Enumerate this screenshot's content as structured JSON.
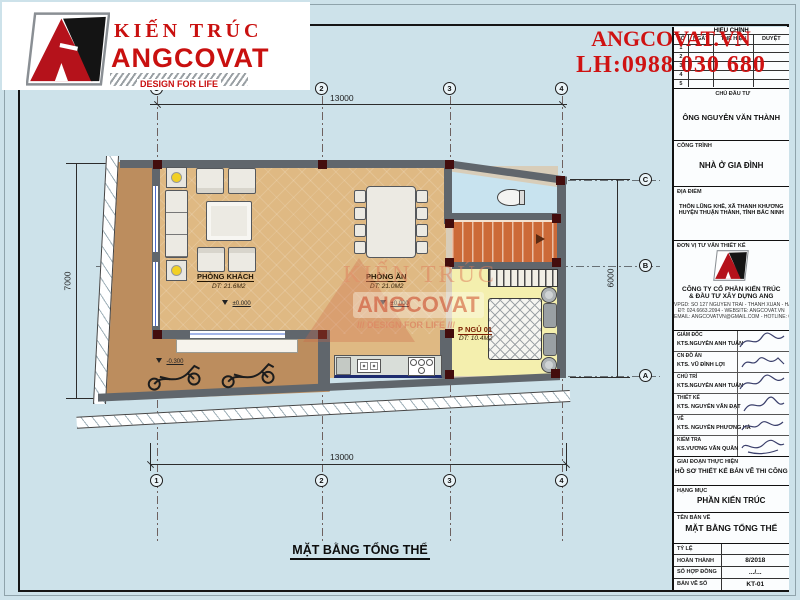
{
  "colors": {
    "background_blue": "#cde2ea",
    "accent_red": "#c9100f",
    "wall_gray": "#60666c",
    "floor_tan": "#dfb983",
    "garage_tan": "#bc8d5e",
    "bedroom_yellow": "#f4efae",
    "wc_blue": "#c8e3ef",
    "stair_orange": "#cc6a38",
    "column_maroon": "#430d0d"
  },
  "logo": {
    "brand_top": "KIẾN TRÚC",
    "brand_main": "ANGCOVAT",
    "tagline": "DESIGN FOR LIFE"
  },
  "contact_header": {
    "website": "ANGCOVAT.VN",
    "phone": "LH:0988 030 680"
  },
  "drawing": {
    "title": "MẶT BẰNG TỔNG THỂ",
    "dimensions": {
      "top": "13000",
      "bottom": "13000",
      "left": "7000",
      "right": "6000"
    },
    "grid": {
      "columns": [
        "1",
        "2",
        "3",
        "4"
      ],
      "rows": [
        "C",
        "B",
        "A"
      ]
    },
    "rooms": {
      "living": {
        "name": "PHÒNG KHÁCH",
        "area": "DT: 21.6M2",
        "level": "±0.000"
      },
      "dining": {
        "name": "PHÒNG ĂN",
        "area": "DT: 21.0M2",
        "level": "±0.000"
      },
      "bedroom": {
        "name": "P NGỦ 01",
        "area": "DT: 10.4M2"
      },
      "garage": {
        "level": "-0.300"
      }
    },
    "watermark": {
      "line1": "KIẾN TRÚC",
      "line2": "ANGCOVAT",
      "line3": "/// DESIGN FOR LIFE ///"
    }
  },
  "titleblock": {
    "revision": {
      "title": "HIỆU CHỈNH",
      "columns": [
        "SỐ",
        "NGÀY",
        "THỂ HIỆN",
        "DUYỆT"
      ],
      "rows": [
        "1",
        "2",
        "3",
        "4",
        "5"
      ]
    },
    "client": {
      "label": "CHỦ ĐẦU TƯ",
      "value": "ÔNG NGUYỄN VĂN THÀNH"
    },
    "project": {
      "label": "CÔNG TRÌNH",
      "value": "NHÀ Ở GIA ĐÌNH"
    },
    "location": {
      "label": "ĐỊA ĐIỂM",
      "line1": "THÔN LŨNG KHÊ, XÃ THANH KHƯƠNG",
      "line2": "HUYỆN THUẬN THÀNH, TỈNH BẮC NINH"
    },
    "consultant": {
      "label": "ĐƠN VỊ TƯ VẤN THIẾT KẾ",
      "company_line1": "CÔNG TY CỔ PHẦN KIẾN TRÚC",
      "company_line2": "& ĐẦU TƯ XÂY DỰNG ANG",
      "contact1": "VPGD: SỐ 127 NGUYỄN TRÃI - THANH XUÂN - HÀ NỘI",
      "contact2": "ĐT: 024.6663.2094 - WEBSITE: ANGCOVAT.VN",
      "contact3": "EMAIL: ANGCOVATVN@GMAIL.COM - HOTLINE: 0988.03.06.80"
    },
    "signatures": [
      {
        "role": "GIÁM ĐỐC",
        "name": "KTS.NGUYỄN ANH TUẤN"
      },
      {
        "role": "CN ĐỒ ÁN",
        "name": "KTS. VŨ ĐÌNH LỢI"
      },
      {
        "role": "CHỦ TRÌ",
        "name": "KTS.NGUYỄN ANH TUẤN"
      },
      {
        "role": "THIẾT KẾ",
        "name": "KTS. NGUYỄN VĂN ĐẠT"
      },
      {
        "role": "VẼ",
        "name": "KTS. NGUYỄN PHƯƠNG HÀ"
      },
      {
        "role": "KIỂM TRA",
        "name": "KS.VƯƠNG VĂN QUÂN"
      }
    ],
    "phase": {
      "label": "GIAI ĐOẠN THỰC HIỆN",
      "value": "HỒ SƠ THIẾT KẾ BẢN VẼ THI CÔNG"
    },
    "category": {
      "label": "HẠNG MỤC",
      "value": "PHẦN KIẾN TRÚC"
    },
    "sheet_name": {
      "label": "TÊN BẢN VẼ",
      "value": "MẶT BẰNG TỔNG THỂ"
    },
    "footer": [
      {
        "label": "TỶ LỆ",
        "value": ""
      },
      {
        "label": "HOÀN THÀNH",
        "value": "8/2018"
      },
      {
        "label": "SỐ HỢP ĐỒNG",
        "value": ".../..."
      },
      {
        "label": "BẢN VẼ SỐ",
        "value": "KT-01"
      }
    ]
  }
}
